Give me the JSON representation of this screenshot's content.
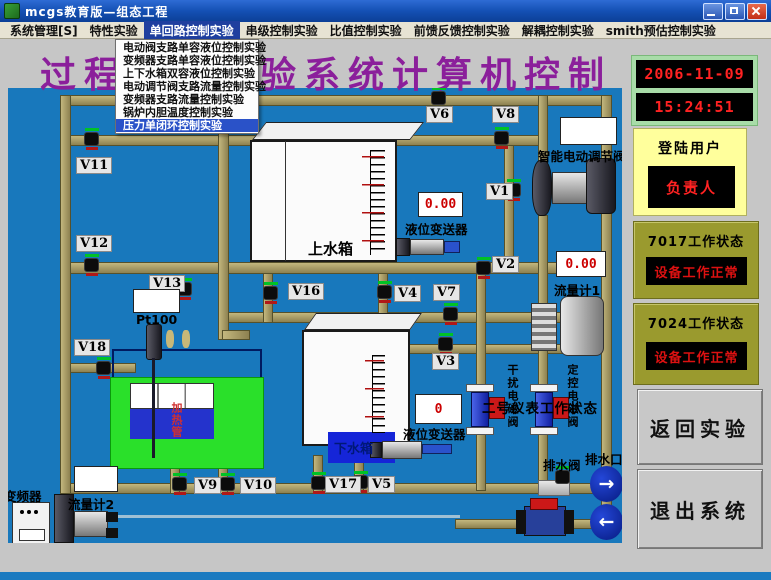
{
  "window": {
    "title": "mcgs教育版—组态工程"
  },
  "menu_bar": {
    "items": [
      {
        "label": "系统管理[S]",
        "active": false
      },
      {
        "label": "特性实验",
        "active": false
      },
      {
        "label": "单回路控制实验",
        "active": true
      },
      {
        "label": "串级控制实验",
        "active": false
      },
      {
        "label": "比值控制实验",
        "active": false
      },
      {
        "label": "前馈反馈控制实验",
        "active": false
      },
      {
        "label": "解耦控制实验",
        "active": false
      },
      {
        "label": "smith预估控制实验",
        "active": false
      }
    ]
  },
  "dropdown": {
    "items": [
      {
        "label": "电动阀支路单容液位控制实验",
        "selected": false
      },
      {
        "label": "变频器支路单容液位控制实验",
        "selected": false
      },
      {
        "label": "上下水箱双容液位控制实验",
        "selected": false
      },
      {
        "label": "电动调节阀支路流量控制实验",
        "selected": false
      },
      {
        "label": "变频器支路流量控制实验",
        "selected": false
      },
      {
        "label": "锅炉内胆温度控制实验",
        "selected": false
      },
      {
        "label": "压力单闭环控制实验",
        "selected": true
      }
    ]
  },
  "page_title": "过程控制实验系统计算机控制",
  "diagram": {
    "valves": [
      {
        "id": "V6",
        "lx": 426,
        "ly": 106,
        "vx": 431,
        "vy": 87
      },
      {
        "id": "V8",
        "lx": 492,
        "ly": 106,
        "vx": 494,
        "vy": 127
      },
      {
        "id": "V11",
        "lx": 76,
        "ly": 157,
        "vx": 84,
        "vy": 128
      },
      {
        "id": "V1",
        "lx": 486,
        "ly": 183,
        "vx": 506,
        "vy": 179
      },
      {
        "id": "V12",
        "lx": 76,
        "ly": 235,
        "vx": 84,
        "vy": 254
      },
      {
        "id": "V2",
        "lx": 492,
        "ly": 256,
        "vx": 476,
        "vy": 257
      },
      {
        "id": "V13",
        "lx": 149,
        "ly": 275,
        "vx": 177,
        "vy": 278
      },
      {
        "id": "V16",
        "lx": 288,
        "ly": 283,
        "vx": 263,
        "vy": 282
      },
      {
        "id": "V4",
        "lx": 394,
        "ly": 285,
        "vx": 377,
        "vy": 281
      },
      {
        "id": "V7",
        "lx": 433,
        "ly": 284,
        "vx": 443,
        "vy": 303
      },
      {
        "id": "V18",
        "lx": 74,
        "ly": 339,
        "vx": 96,
        "vy": 357
      },
      {
        "id": "V3",
        "lx": 432,
        "ly": 353,
        "vx": 438,
        "vy": 333
      },
      {
        "id": "V9",
        "lx": 194,
        "ly": 477,
        "vx": 172,
        "vy": 473
      },
      {
        "id": "V10",
        "lx": 240,
        "ly": 477,
        "vx": 220,
        "vy": 473
      },
      {
        "id": "V17",
        "lx": 325,
        "ly": 476,
        "vx": 311,
        "vy": 472
      },
      {
        "id": "V5",
        "lx": 368,
        "ly": 476,
        "vx": 353,
        "vy": 471
      }
    ],
    "displays": [
      {
        "name": "upper-level-display",
        "value": "0.00",
        "x": 418,
        "y": 192,
        "w": 45,
        "h": 25
      },
      {
        "name": "flow1-display",
        "value": "0.00",
        "x": 556,
        "y": 251,
        "w": 50,
        "h": 26
      },
      {
        "name": "lower-level-display",
        "value": "0",
        "x": 415,
        "y": 394,
        "w": 47,
        "h": 30
      },
      {
        "name": "flow2-display",
        "value": "",
        "x": 74,
        "y": 466,
        "w": 44,
        "h": 26
      },
      {
        "name": "temp-display",
        "value": "",
        "x": 133,
        "y": 289,
        "w": 47,
        "h": 24
      },
      {
        "name": "valve-display",
        "value": "",
        "x": 560,
        "y": 117,
        "w": 57,
        "h": 28
      }
    ],
    "labels": [
      {
        "text": "上水箱",
        "x": 308,
        "y": 238,
        "cls": "tank-label"
      },
      {
        "text": "下水箱",
        "x": 334,
        "y": 438,
        "cls": "water-label"
      },
      {
        "text": "液位变送器",
        "x": 405,
        "y": 219,
        "cls": "small"
      },
      {
        "text": "液位变送器",
        "x": 403,
        "y": 424,
        "cls": "small"
      },
      {
        "text": "流量计1",
        "x": 554,
        "y": 280,
        "cls": "small"
      },
      {
        "text": "流量计2",
        "x": 68,
        "y": 494,
        "cls": "small"
      },
      {
        "text": "变频器",
        "x": 4,
        "y": 486,
        "cls": "small"
      },
      {
        "text": "智能电动调节阀",
        "x": 538,
        "y": 146,
        "cls": "small"
      },
      {
        "text": "Pt100",
        "x": 136,
        "y": 312,
        "cls": "small"
      },
      {
        "text": "加热管",
        "x": 168,
        "y": 402,
        "cls": "vred"
      },
      {
        "text": "干扰电磁阀",
        "x": 504,
        "y": 364,
        "cls": "vert"
      },
      {
        "text": "定控电磁阀",
        "x": 564,
        "y": 364,
        "cls": "vert"
      },
      {
        "text": "二号仪表工作状态",
        "x": 482,
        "y": 397,
        "cls": "overlay"
      },
      {
        "text": "排水阀",
        "x": 543,
        "y": 455,
        "cls": "small"
      },
      {
        "text": "排水口",
        "x": 585,
        "y": 449,
        "cls": "small"
      }
    ],
    "icons": {
      "drain_out_arrow": "→",
      "drain_in_arrow": "←"
    }
  },
  "sidebar": {
    "date": "2006-11-09",
    "time": "15:24:51",
    "login": {
      "title": "登陆用户",
      "value": "负责人"
    },
    "status_7017": {
      "title": "7017工作状态",
      "value": "设备工作正常"
    },
    "status_7024": {
      "title": "7024工作状态",
      "value": "设备工作正常"
    },
    "back_button": "返回实验",
    "exit_button": "退出系统"
  },
  "colors": {
    "diagram_background": "#1878bc",
    "pipe": "#a29158",
    "title_purple": "#8b1f9b",
    "display_text_red": "#cc0000",
    "clock_text_red": "#ff2222",
    "panel_olive": "#9a9a2e",
    "panel_yellow": "#ffff9c",
    "clock_frame_green": "#a8dca8",
    "menu_highlight_blue": "#1f3f9f",
    "dropdown_highlight_blue": "#2a52c8",
    "water_blue": "#1525d8",
    "boiler_green": "#2ae02a"
  }
}
